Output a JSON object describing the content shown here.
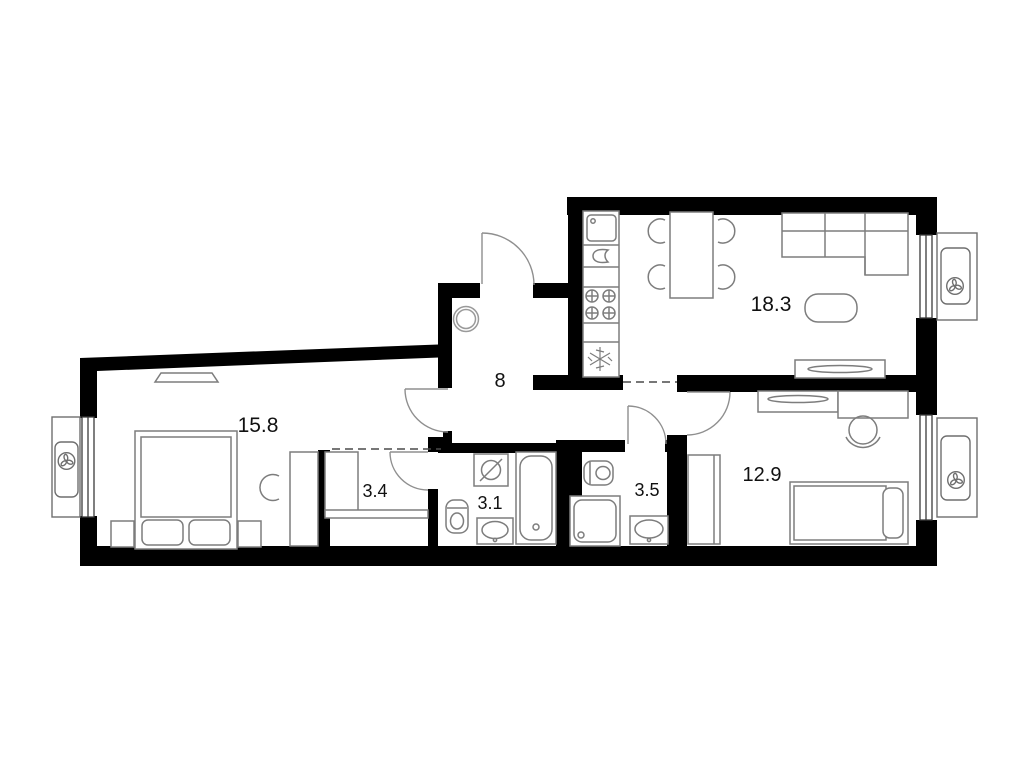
{
  "floor_plan": {
    "type": "apartment-floor-plan",
    "rooms": [
      {
        "id": "kitchen-living-room",
        "area": "18.3"
      },
      {
        "id": "bedroom-main",
        "area": "15.8"
      },
      {
        "id": "bedroom-second",
        "area": "12.9"
      },
      {
        "id": "hallway",
        "area": "8"
      },
      {
        "id": "wardrobe-closet",
        "area": "3.4"
      },
      {
        "id": "bathroom",
        "area": "3.1"
      },
      {
        "id": "shower-room",
        "area": "3.5"
      }
    ],
    "colors": {
      "walls": "#000000",
      "background": "#ffffff",
      "furniture_outline": "#7d7d7d",
      "door_arc": "#8f8f8f",
      "label_text": "#111111"
    }
  }
}
